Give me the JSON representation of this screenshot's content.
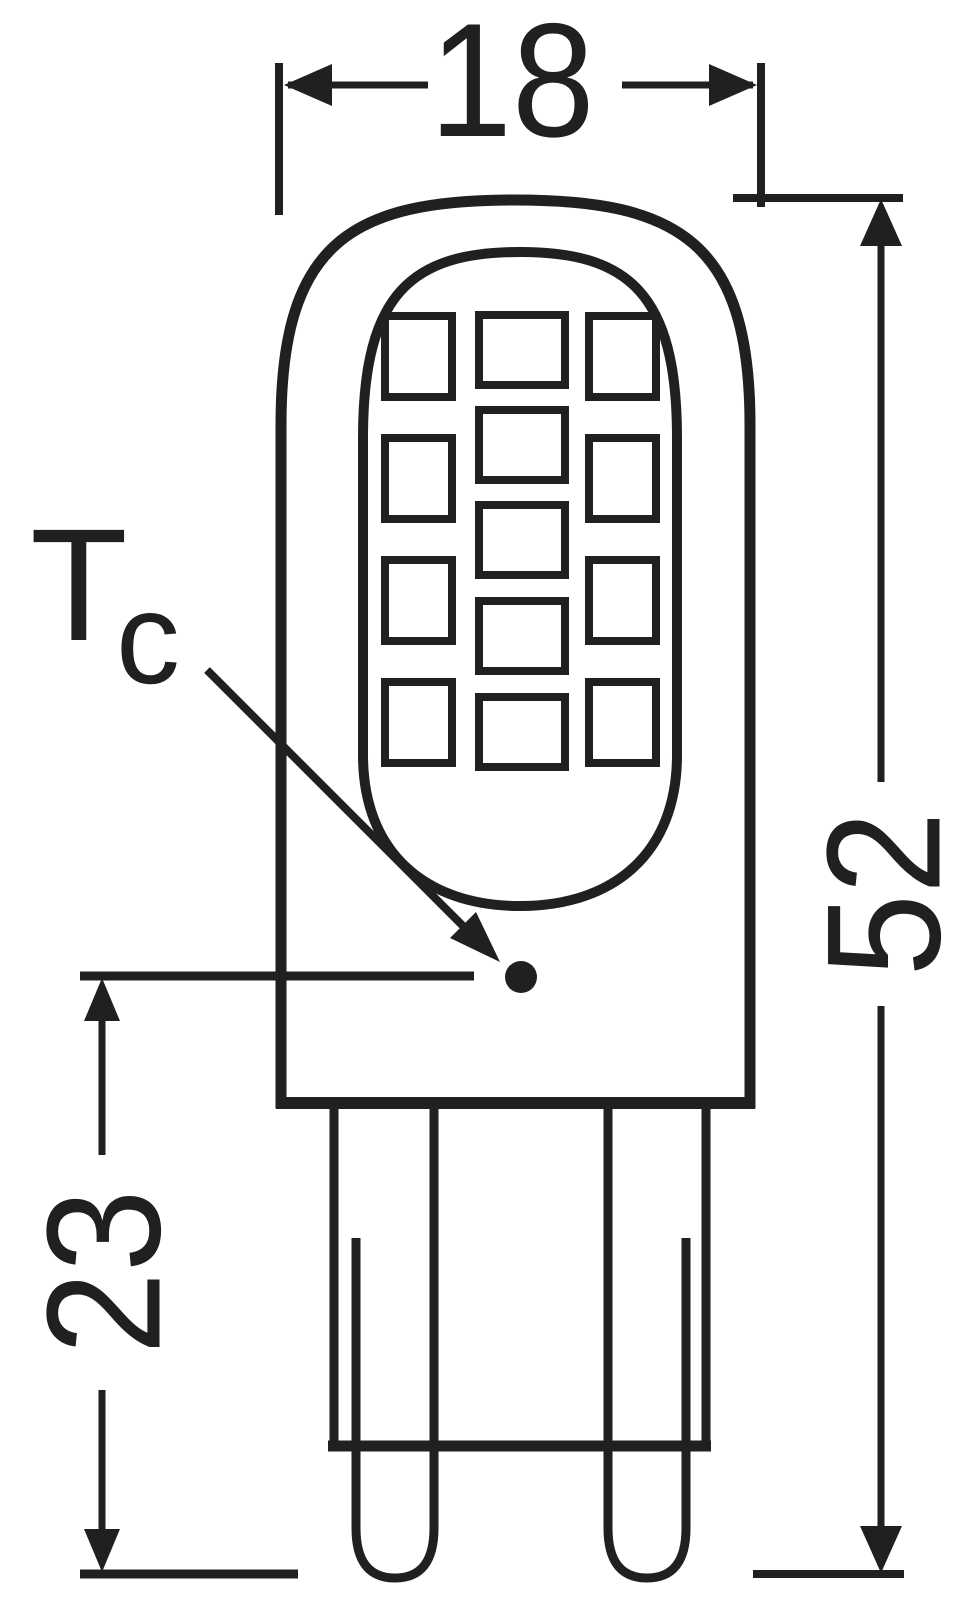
{
  "page": {
    "background_color": "#ffffff"
  },
  "drawing": {
    "kind": "technical dimension drawing",
    "subject": "G9 LED capsule lamp, front view",
    "line_color": "#221f1f"
  },
  "dimensions": {
    "width_top": "18",
    "overall_height_right": "52",
    "base_height_left": "23"
  },
  "thermal_point": {
    "label_main": "T",
    "label_sub": "c"
  },
  "led_grid": {
    "columns": 3,
    "rows_left": 4,
    "rows_center": 5,
    "rows_right": 4,
    "total_chips": 13
  }
}
